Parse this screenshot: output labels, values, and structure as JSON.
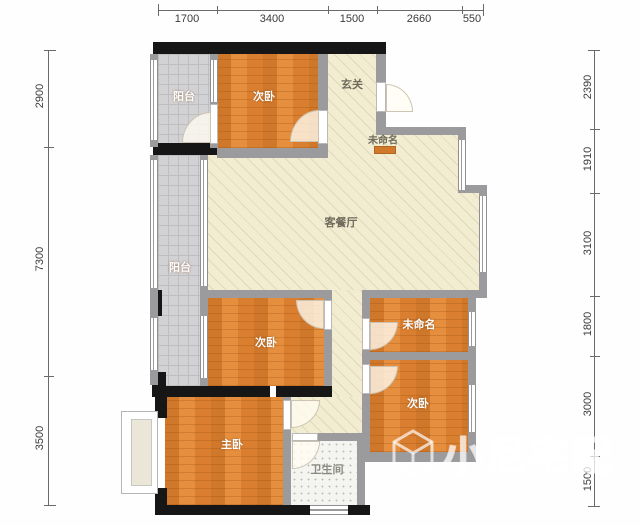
{
  "plan": {
    "rooms": [
      {
        "name": "balcony-top",
        "label": "阳台"
      },
      {
        "name": "bedroom-top",
        "label": "次卧"
      },
      {
        "name": "entry-hall",
        "label": "玄关"
      },
      {
        "name": "unnamed-top",
        "label": "未命名"
      },
      {
        "name": "living-dining",
        "label": "客餐厅"
      },
      {
        "name": "balcony-left",
        "label": "阳台"
      },
      {
        "name": "bedroom-middle",
        "label": "次卧"
      },
      {
        "name": "unnamed-right",
        "label": "未命名"
      },
      {
        "name": "bedroom-right",
        "label": "次卧"
      },
      {
        "name": "master-bedroom",
        "label": "主卧"
      },
      {
        "name": "bathroom",
        "label": "卫生间"
      }
    ]
  },
  "dimensions": {
    "top": [
      "1700",
      "3400",
      "1500",
      "2660",
      "550"
    ],
    "left": [
      "2900",
      "7300",
      "3500"
    ],
    "right": [
      "2390",
      "1910",
      "3100",
      "1800",
      "3000",
      "1500"
    ]
  },
  "watermark": {
    "text": "小尼宅配"
  },
  "colors": {
    "wood_floor": "#df8434",
    "living_floor": "#f2ecd1",
    "balcony_tile": "#d2d1d3",
    "wall_gray": "#9b9a9c",
    "wall_black": "#161616"
  }
}
